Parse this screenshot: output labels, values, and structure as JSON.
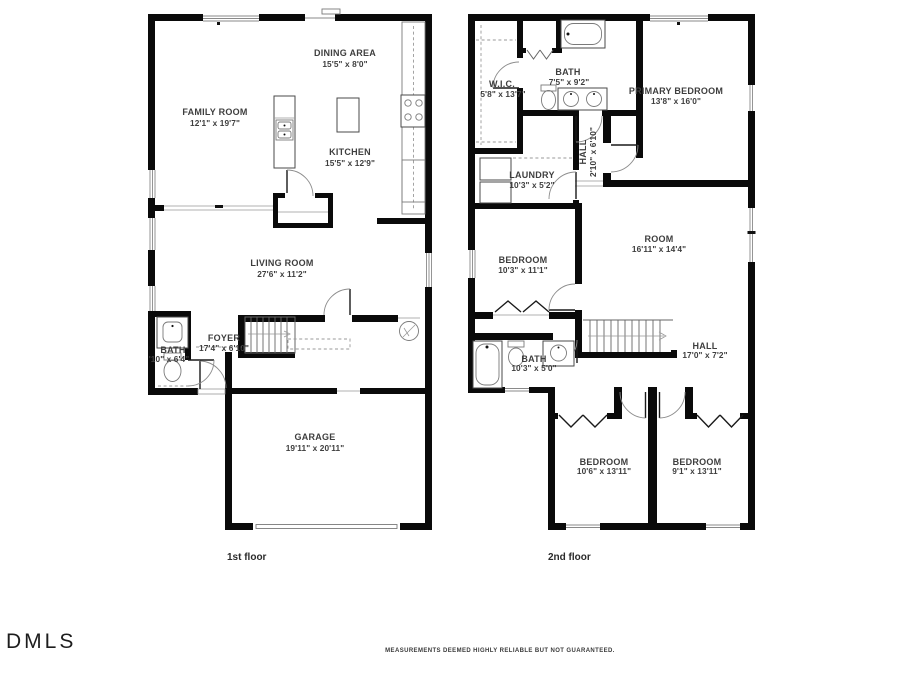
{
  "footer": {
    "logo": "DMLS",
    "disclaimer": "MEASUREMENTS DEEMED HIGHLY RELIABLE BUT NOT GUARANTEED."
  },
  "floor1": {
    "caption": "1st floor",
    "family_room": {
      "name": "FAMILY ROOM",
      "dims": "12'1\" x 19'7\""
    },
    "dining_area": {
      "name": "DINING AREA",
      "dims": "15'5\" x 8'0\""
    },
    "kitchen": {
      "name": "KITCHEN",
      "dims": "15'5\" x 12'9\""
    },
    "living_room": {
      "name": "LIVING ROOM",
      "dims": "27'6\" x 11'2\""
    },
    "foyer": {
      "name": "FOYER",
      "dims": "17'4\" x 6'10\""
    },
    "bath": {
      "name": "BATH",
      "dims": "'10\" x 6'4\""
    },
    "garage": {
      "name": "GARAGE",
      "dims": "19'11\" x 20'11\""
    }
  },
  "floor2": {
    "caption": "2nd floor",
    "wic": {
      "name": "W.I.C.",
      "dims": "5'8\" x 13'7\""
    },
    "bath_top": {
      "name": "BATH",
      "dims": "7'5\" x 9'2\""
    },
    "primary_bedroom": {
      "name": "PRIMARY BEDROOM",
      "dims": "13'8\" x 16'0\""
    },
    "hall_small": {
      "name": "HALL",
      "dims": "2'10\" x 6'10\""
    },
    "laundry": {
      "name": "LAUNDRY",
      "dims": "10'3\" x 5'2\""
    },
    "room": {
      "name": "ROOM",
      "dims": "16'11\" x 14'4\""
    },
    "bedroom_mid": {
      "name": "BEDROOM",
      "dims": "10'3\" x 11'1\""
    },
    "bath_low": {
      "name": "BATH",
      "dims": "10'3\" x 5'0\""
    },
    "hall": {
      "name": "HALL",
      "dims": "17'0\" x 7'2\""
    },
    "bedroom_left": {
      "name": "BEDROOM",
      "dims": "10'6\" x 13'11\""
    },
    "bedroom_right": {
      "name": "BEDROOM",
      "dims": "9'1\" x 13'11\""
    }
  }
}
